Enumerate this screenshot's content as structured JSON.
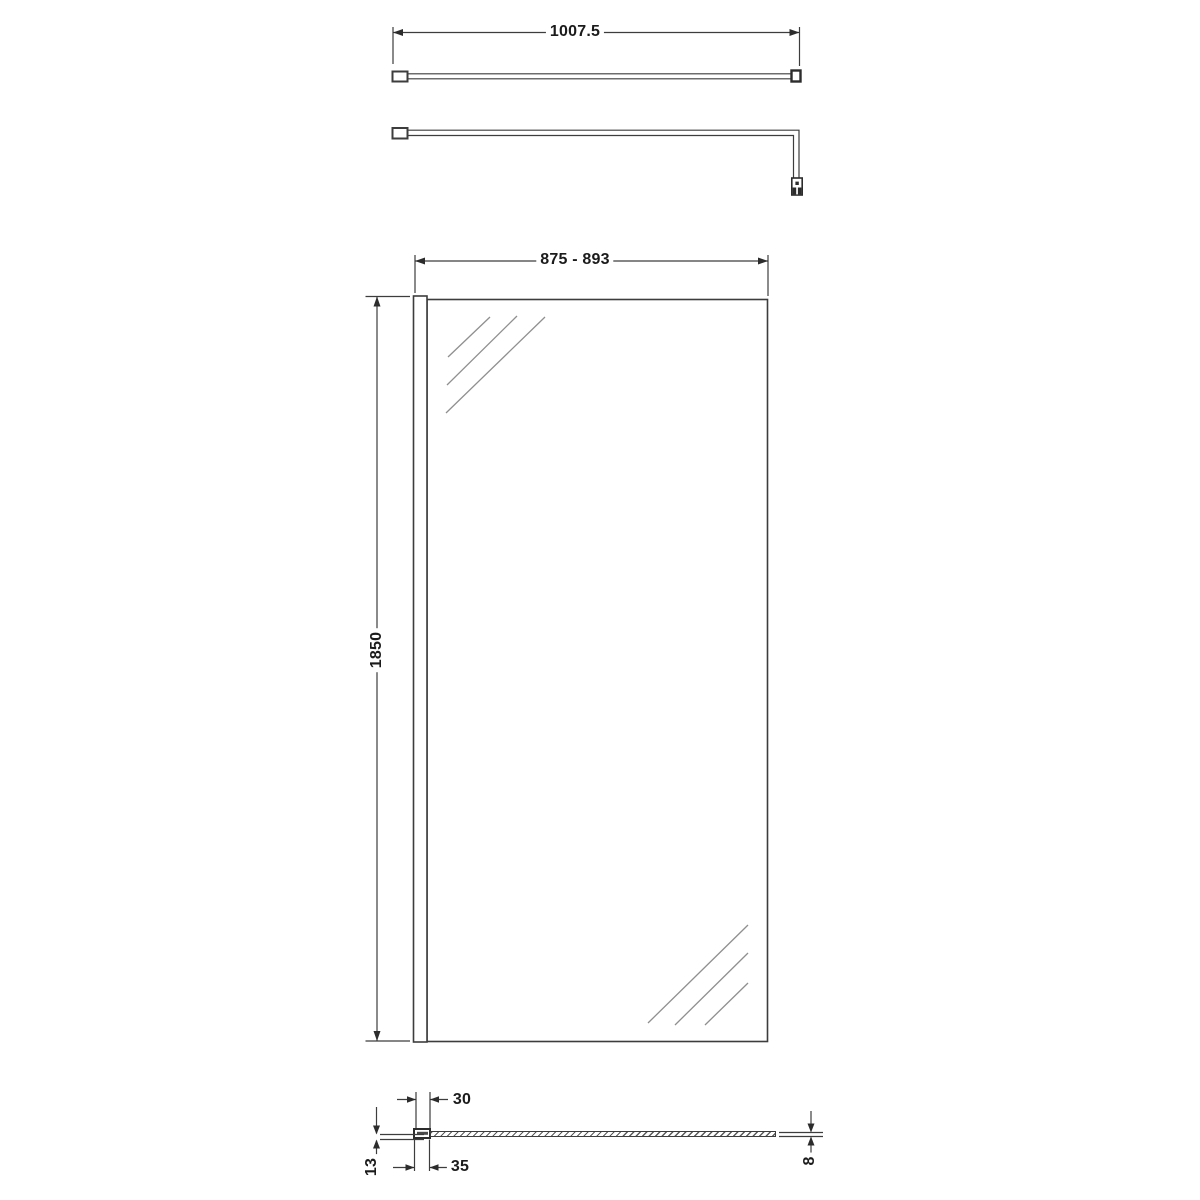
{
  "drawing": {
    "arm_top_view": {
      "dimension_width": "1007.5"
    },
    "panel_front_view": {
      "dimension_width": "875 - 893",
      "dimension_height": "1850"
    },
    "panel_plan_view": {
      "dimension_profile_cover": "30",
      "dimension_profile_base": "35",
      "dimension_profile_depth": "13",
      "dimension_glass_thickness": "8"
    }
  },
  "colors": {
    "line": "#3d3d3d",
    "text": "#1b1b1b",
    "hatch": "#8f8f8f",
    "background": "#ffffff"
  }
}
